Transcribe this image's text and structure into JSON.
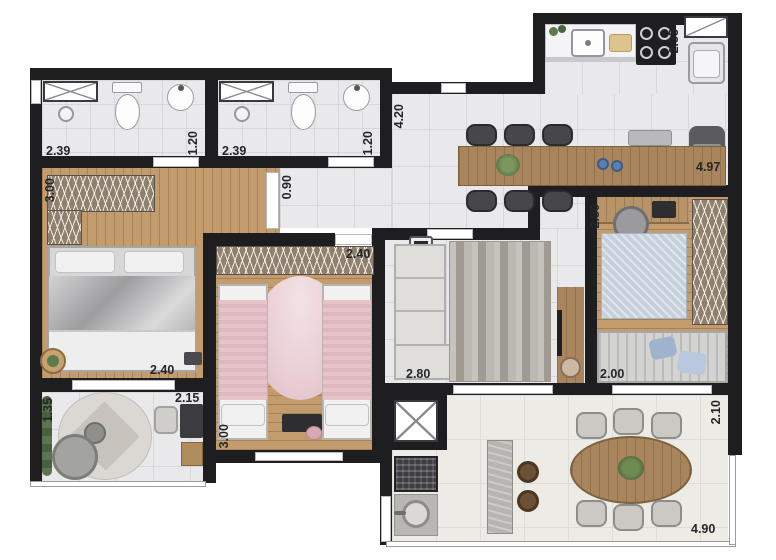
{
  "plan_type": "apartment-floor-plan",
  "dims": {
    "bathroom1": {
      "width": "2.39",
      "depth": "1.20"
    },
    "bathroom2": {
      "width": "2.39",
      "depth": "1.20"
    },
    "master_bedroom": {
      "width": "3.00",
      "length": "2.40"
    },
    "corridor": {
      "width": "0.90"
    },
    "dining": {
      "length": "4.20"
    },
    "kitchen": {
      "service_depth": "2.35",
      "counter_length": "4.97"
    },
    "study": {
      "width": "2.80",
      "sofa_wall": "2.00"
    },
    "bedroom2": {
      "width": "2.40",
      "length": "3.00"
    },
    "living": {
      "width": "2.80"
    },
    "den": {
      "depth": "1.35",
      "width": "2.15"
    },
    "balcony": {
      "depth": "2.10",
      "length": "4.90"
    }
  },
  "colors": {
    "wall": "#1e1e20",
    "tile": "#e9e9ec",
    "tile-line": "#d7d7dc",
    "wood": "#c29c6c",
    "wood-dark": "#a8855d",
    "hatch": "#8f7f6b",
    "balcony-floor": "#edebe6",
    "pink": "#e9cfd4",
    "blue": "#c6d0dd",
    "green": "#5d7a4c",
    "label": "#26262a"
  }
}
